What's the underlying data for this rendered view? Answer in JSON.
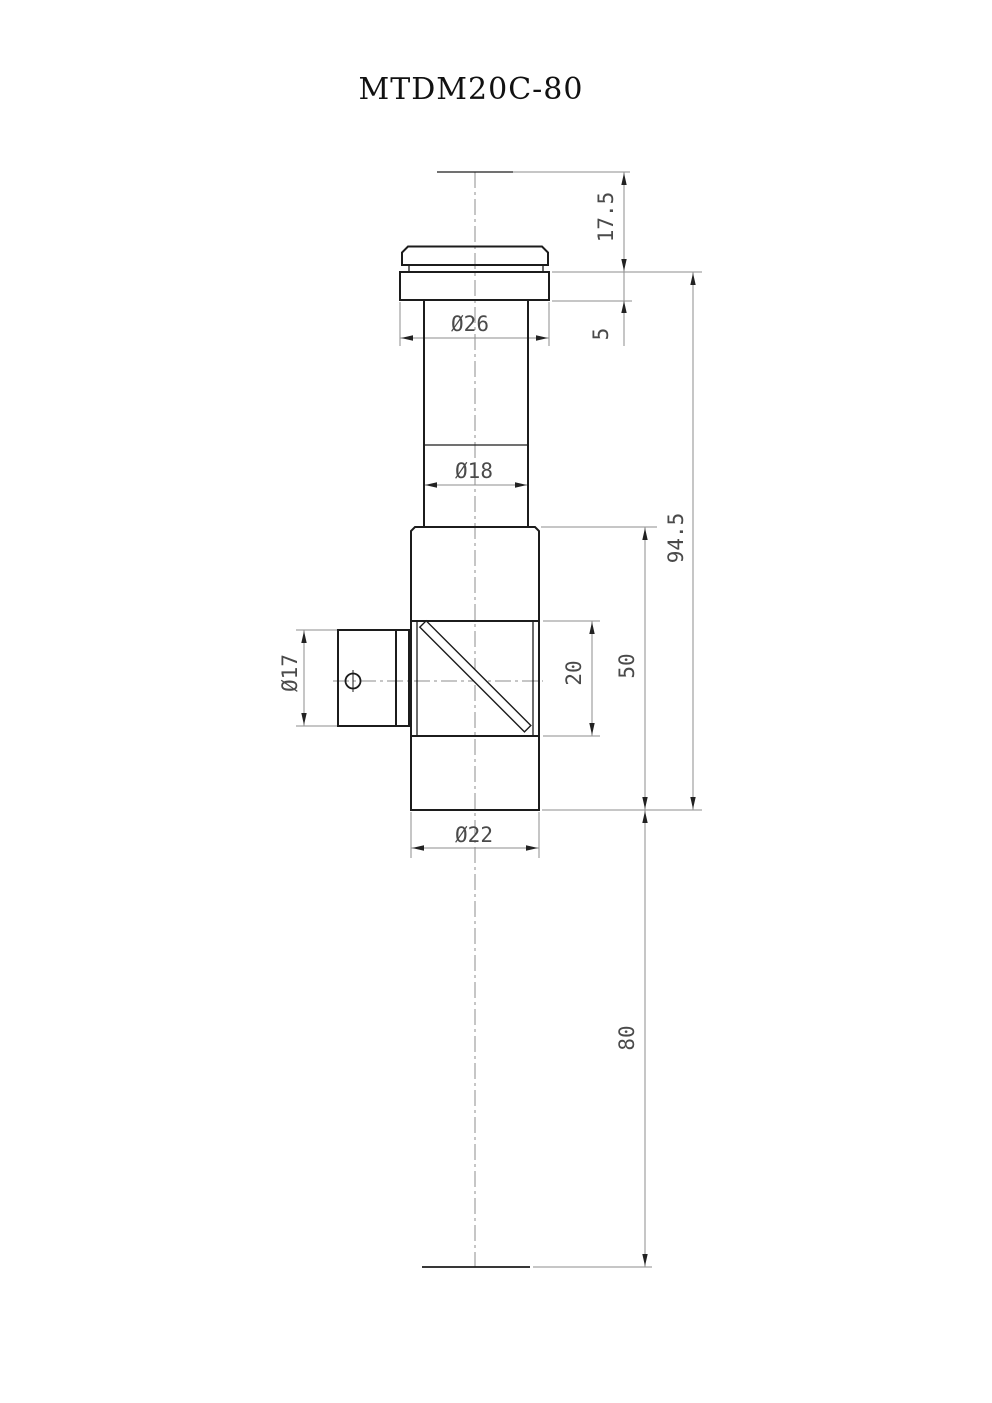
{
  "title": "MTDM20C-80",
  "drawing": {
    "type": "mechanical-part-drawing",
    "part_features": [
      "top-cap",
      "flange",
      "neck",
      "main-body",
      "beamsplitter-window",
      "diagonal-mirror",
      "side-port",
      "set-screw-hole"
    ],
    "dimensions": {
      "top_offset": "17.5",
      "flange_thickness": "5",
      "flange_diameter": "Ø26",
      "neck_diameter": "Ø18",
      "overall_length": "94.5",
      "body_length": "50",
      "window_height": "20",
      "side_port_diameter": "Ø17",
      "body_diameter": "Ø22",
      "bottom_extension": "80"
    }
  },
  "colors": {
    "background": "#ffffff",
    "outline": "#1c1c1c",
    "dimension_lines": "#8d8d8d",
    "dimension_text": "#4a4a4a",
    "title_text": "#111111"
  }
}
